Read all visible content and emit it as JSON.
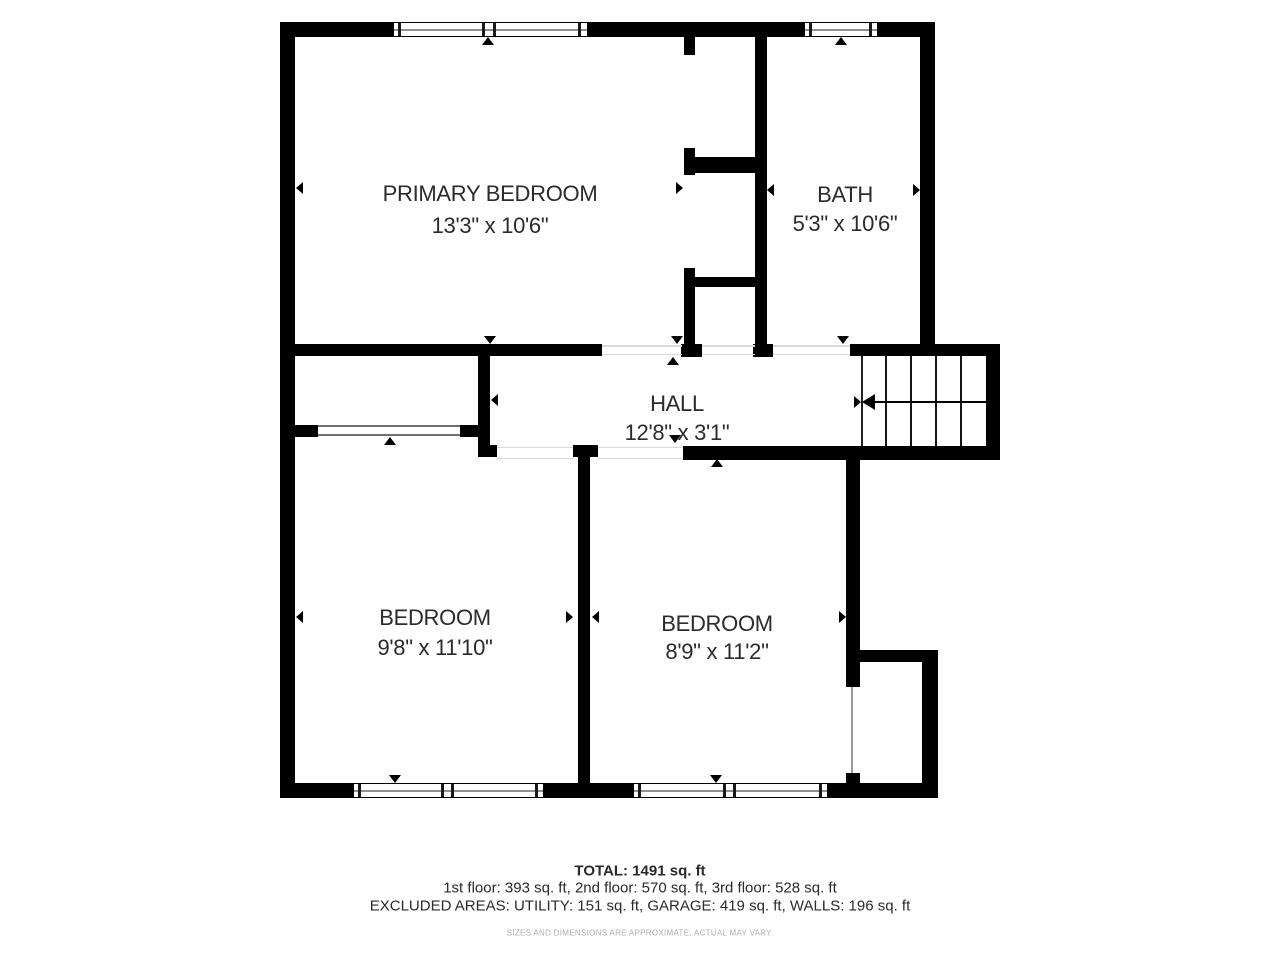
{
  "floorplan": {
    "rooms": [
      {
        "name": "PRIMARY BEDROOM",
        "dims": "13'3\" x 10'6\""
      },
      {
        "name": "BATH",
        "dims": "5'3\" x 10'6\""
      },
      {
        "name": "HALL",
        "dims": "12'8\" x 3'1\""
      },
      {
        "name": "BEDROOM",
        "dims": "9'8\" x 11'10\""
      },
      {
        "name": "BEDROOM",
        "dims": "8'9\" x 11'2\""
      }
    ],
    "colors": {
      "wall": "#000000",
      "background": "#ffffff",
      "label_text": "#2b2b2b",
      "disclaimer_text": "#adadad"
    }
  },
  "footer": {
    "total": "TOTAL: 1491 sq. ft",
    "floors": "1st floor: 393 sq. ft, 2nd floor: 570 sq. ft, 3rd floor: 528 sq. ft",
    "excluded": "EXCLUDED AREAS: UTILITY: 151 sq. ft, GARAGE: 419 sq. ft, WALLS: 196 sq. ft",
    "disclaimer": "SIZES AND DIMENSIONS ARE APPROXIMATE, ACTUAL MAY VARY."
  }
}
